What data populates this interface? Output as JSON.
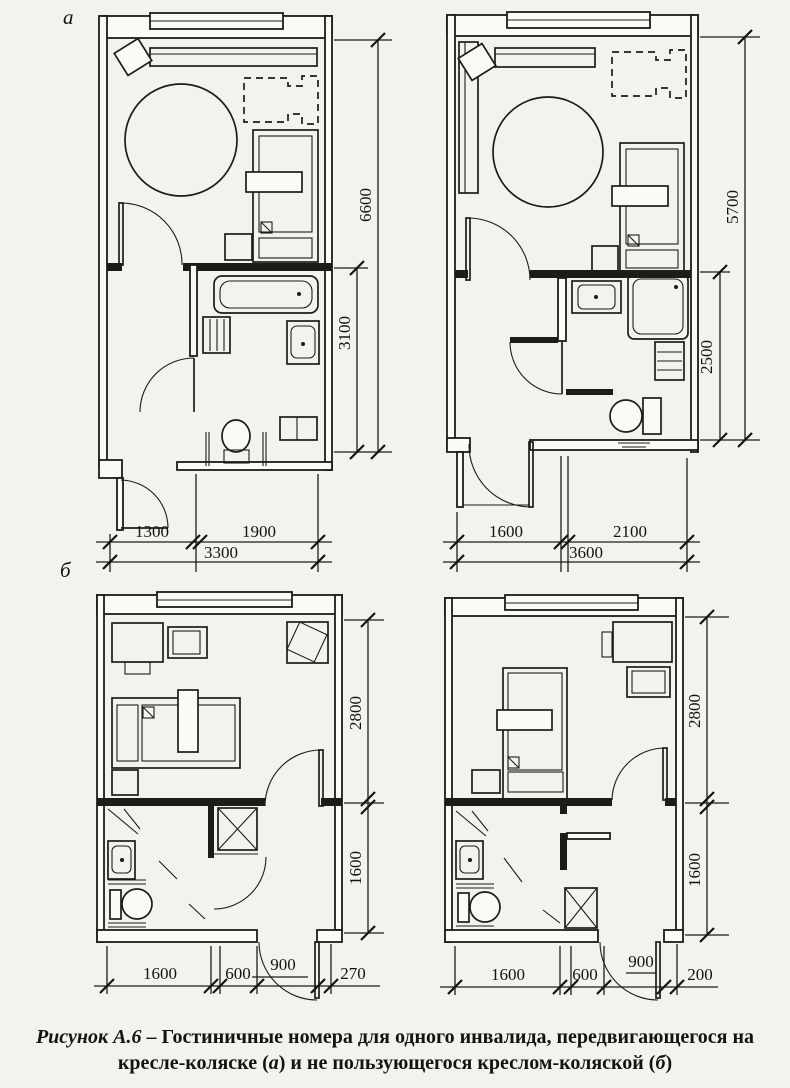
{
  "figure": {
    "label_plan_a": "а",
    "label_plan_b": "б"
  },
  "caption": {
    "figure_label": "Рисунок А.6",
    "separator": " – ",
    "text_main": "Гостиничные номера для одного инвалида, передвигающегося на кресле-коляске (",
    "letter_a": "а",
    "text_mid": ") и не пользующегося креслом-коляской (",
    "letter_b": "б",
    "text_end": ")"
  },
  "plans": {
    "a_left": {
      "h_total": "6600",
      "h_lower": "3100",
      "w1": "1300",
      "w2": "1900",
      "w_total": "3300"
    },
    "a_right": {
      "h_total": "5700",
      "h_lower": "2500",
      "w1": "1600",
      "w2": "2100",
      "w_total": "3600"
    },
    "b_left": {
      "h_upper": "2800",
      "h_lower": "1600",
      "w1": "1600",
      "w2": "600",
      "w3": "900",
      "w4": "270"
    },
    "b_right": {
      "h_upper": "2800",
      "h_lower": "1600",
      "w1": "1600",
      "w2": "600",
      "w3": "900",
      "w4": "200"
    }
  }
}
